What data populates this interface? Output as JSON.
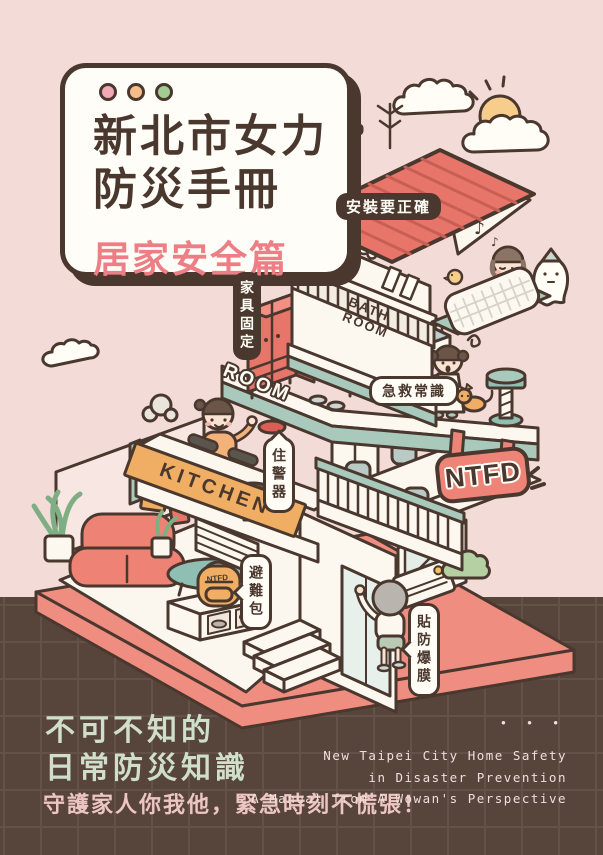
{
  "title_card": {
    "line1": "新北市女力",
    "line2": "防災手冊",
    "line3": "居家安全篇"
  },
  "callouts": {
    "install": "安裝要正確",
    "furniture": "家具固定",
    "first_aid": "急救常識",
    "alarm": "住警器",
    "go_bag": "避難包",
    "film": "貼防爆膜"
  },
  "signs": {
    "bath_line1": "BATH",
    "bath_line2": "ROOM",
    "kitchen": "KITCHEN",
    "room_floor": "ROOM",
    "ntfd": "NTFD",
    "backpack": "NTFD"
  },
  "decorations": {
    "music_note_big": "♪",
    "music_note_small": "♪"
  },
  "footer": {
    "dots": "•  •  •",
    "headline_line1": "不可不知的",
    "headline_line2": "日常防災知識",
    "subline": "守護家人你我他，緊急時刻不慌張！",
    "english_line1": "New Taipei City Home Safety",
    "english_line2": "in Disaster Prevention",
    "english_line3": "A Manual from A Wowan's Perspective"
  },
  "colors": {
    "background_pink": "#f3dcd7",
    "background_brown": "#57453c",
    "outline_brown": "#4a382f",
    "roof_red": "#e7756a",
    "platform_salmon": "#ef8d80",
    "sign_salmon": "#ee8477",
    "accent_orange": "#efae63",
    "accent_teal": "#a9c9bd",
    "title_pink": "#ee7e85",
    "footer_mint": "#cfdfca",
    "footer_pink": "#eec6c1"
  }
}
